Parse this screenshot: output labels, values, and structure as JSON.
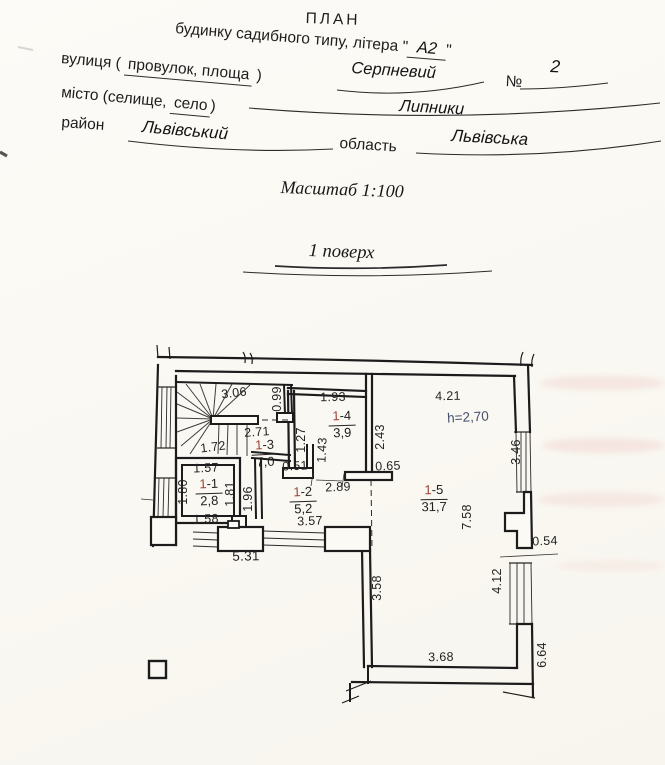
{
  "header": {
    "title": "ПЛАН",
    "subtitle_prefix": "будинку садибного типу, літера \"",
    "subtitle_value": "А2",
    "subtitle_suffix": "\"",
    "street_label_pre": "вулиця ( ",
    "street_label_mid": "провулок, площа",
    "street_label_post": " )",
    "street_value": "Серпневий",
    "number_sign": "№",
    "number_value": "2",
    "city_label_pre": "місто (селище, ",
    "city_label_mid": "село",
    "city_label_post": ")",
    "city_value": "Липники",
    "district_label": "район",
    "district_value": "Львівський",
    "region_label": "область",
    "region_value": "Львівська",
    "scale_text": "Масштаб 1:100",
    "floor_text": "1 поверх"
  },
  "plan": {
    "height_note": "h=2,70",
    "rooms": {
      "r1": {
        "prefix": "1",
        "suffix": "-1",
        "area": "2,8"
      },
      "r2": {
        "prefix": "1",
        "suffix": "-2",
        "area": "5,2"
      },
      "r3": {
        "prefix": "1",
        "suffix": "-3",
        "area": "7,0"
      },
      "r4": {
        "prefix": "1",
        "suffix": "-4",
        "area": "3,9"
      },
      "r5": {
        "prefix": "1",
        "suffix": "-5",
        "area": "31,7"
      }
    },
    "dims": {
      "d306": "3.06",
      "d099": "0.99",
      "d193": "1.93",
      "d421": "4.21",
      "d243": "2.43",
      "d346": "3.46",
      "d271": "2.71",
      "d127": "1.27",
      "d143": "1.43",
      "d172": "1.72",
      "d051": "0.51",
      "d065": "0.65",
      "d157": "1.57",
      "d180": "1.80",
      "d181": "1.81",
      "d196": "1.96",
      "d289": "2.89",
      "d158": "1.58",
      "d531": "5.31",
      "d357": "3.57",
      "d054": "0.54",
      "d758": "7.58",
      "d358": "3.58",
      "d412": "4.12",
      "d368": "3.68",
      "d664": "6.64"
    }
  },
  "colors": {
    "paper": "#fbf9f4",
    "ink": "#1c1c1c",
    "room_number_red": "#9c4335",
    "height_note_blue": "#465070"
  }
}
